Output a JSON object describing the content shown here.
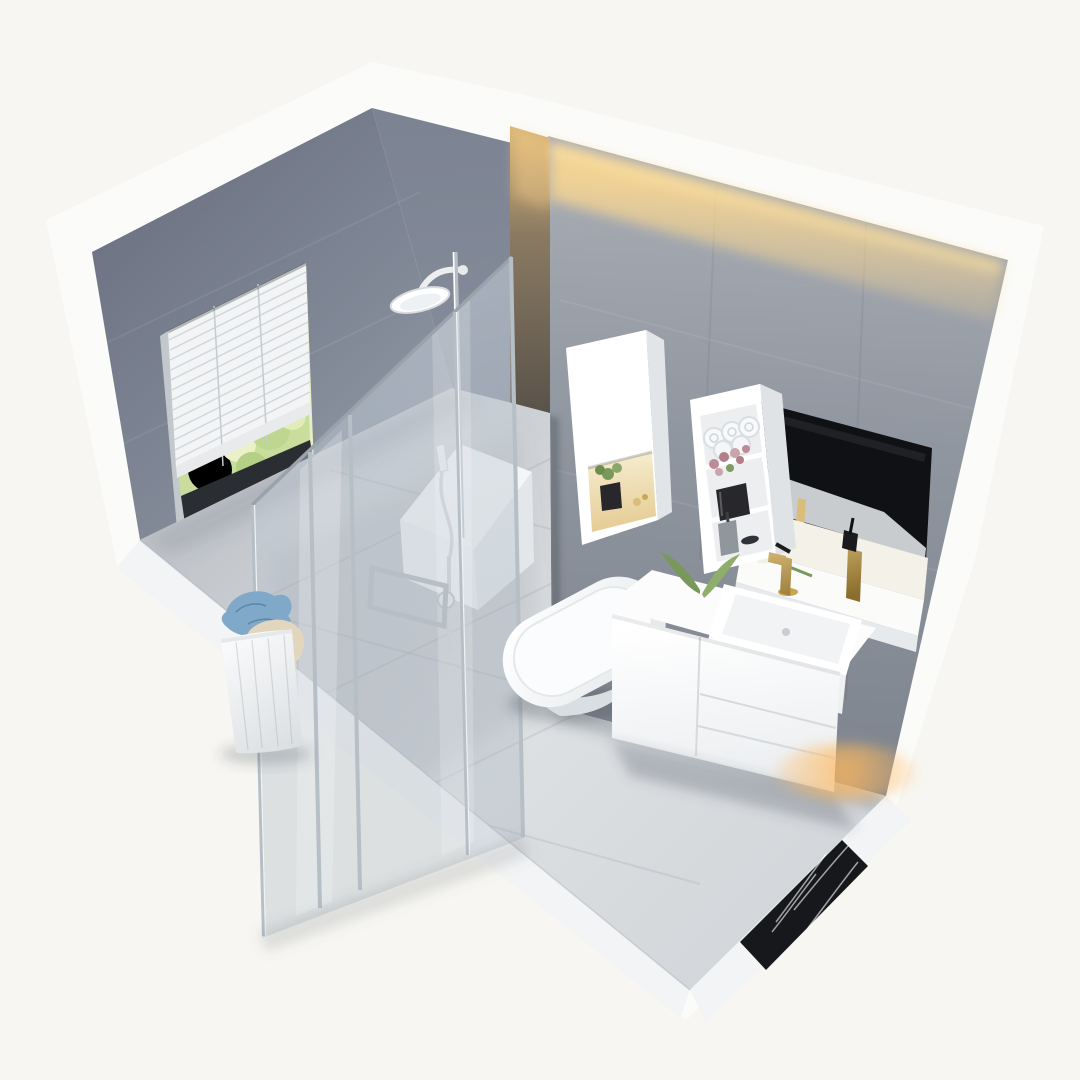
{
  "scene": {
    "type": "3d-isometric-bathroom-render",
    "description": "Axonometric cutaway render of a small modern bathroom: gray tiled walls, window with white venetian blinds and garden view, walk-in glass shower with chrome rain shower set, laundry basket with clothes, white smart toilet, wall-hung tall cabinet with warm lit niche, open shelf unit with rolled towels and flowers, black mirror, white vanity with square vessel sink and gold faucet, warm LED cove lighting, black marble floor border strip.",
    "objects": [
      "left-wall-with-window",
      "venetian-blinds",
      "garden-view",
      "rain-shower-set",
      "glass-shower-enclosure",
      "shower-bench",
      "laundry-basket",
      "smart-toilet",
      "tall-cabinet-lit-niche",
      "open-shelf-tower",
      "towel-rolls",
      "flower-pot",
      "black-mirror",
      "wall-niche-shelf",
      "gold-tumbler",
      "vanity-cabinet",
      "vessel-sink",
      "gold-faucet",
      "led-cove-light",
      "black-marble-floor-strip"
    ]
  },
  "colors": {
    "background": "#f7f6f2",
    "silhouette_white": "#fbfbfa",
    "wallA_dark": "#6e7484",
    "wallA_light": "#9aa1ad",
    "wallB": "#868d9b",
    "wallC_top": "#a9aeb6",
    "wallC_bottom": "#7d838d",
    "warm_face_top": "#d9b678",
    "warm_face_bottom": "#554f48",
    "led_glow": "#ffd98f",
    "floor_light": "#dde0e2",
    "floor_dark": "#c3c7cc",
    "curb": "#f3f4f5",
    "marble": "#17181c",
    "marble_vein": "rgba(255,255,255,0.6)",
    "chrome": "#b6bec6",
    "fixture_white": "#ffffff",
    "fixture_shade": "#e3e7ea",
    "towel": "#f8f9fa",
    "towel_edge": "#d9dee2",
    "flower": "#bd8b97",
    "plant": "#79985b",
    "pot": "#27272c",
    "gold_light": "#d9bd78",
    "gold_dark": "#8b6d2d",
    "cloth_blue": "#7fa8c9",
    "cloth_beige": "#e3d6bf",
    "mirror": "#101114",
    "niche_warm": "#f6ecce",
    "dispenser": "#8f969c",
    "blinds": "#f2f4f5",
    "slat_line": "#b7bec4",
    "greenery_a": "#e7eec6",
    "greenery_b": "#c9dd9c",
    "sill": "#2a2d31",
    "bench_white": "#f4f5f6",
    "shadow": "rgba(70,76,88,0.25)"
  }
}
